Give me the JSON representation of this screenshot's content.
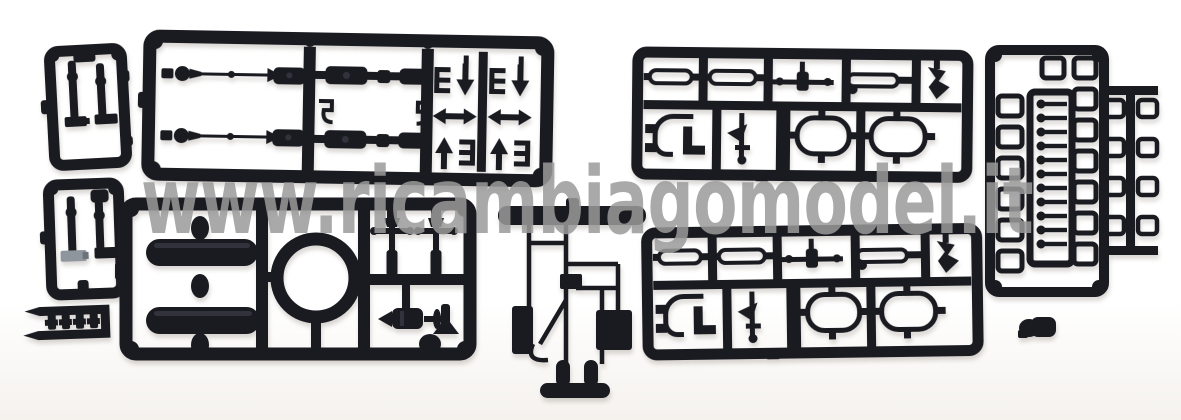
{
  "image": {
    "type": "product-photo",
    "subject": "Black plastic model railway kit sprues (spare detail parts) laid on a white background",
    "background_color": "#ffffff",
    "plastic_color": "#1a1a21",
    "unpainted_part_color": "#8e959c",
    "objects": [
      "small rectangular sprue top-left",
      "small rectangular sprue mid-left",
      "small strip sprue bottom-left",
      "large sprue with axles, cylinders and arrow parts (top center)",
      "sprue with two tanks and a ring (bottom left-center)",
      "mast/ladder sprue with base plate (bottom center)",
      "detail-part sprue upper right",
      "detail-part sprue lower right (duplicate)",
      "vertical sprue with window frames and rung pins (far right)",
      "loose coupler part bottom right"
    ]
  },
  "watermark": {
    "text": "www.ricambiagomodel.it",
    "color": "#9b9b9b"
  }
}
